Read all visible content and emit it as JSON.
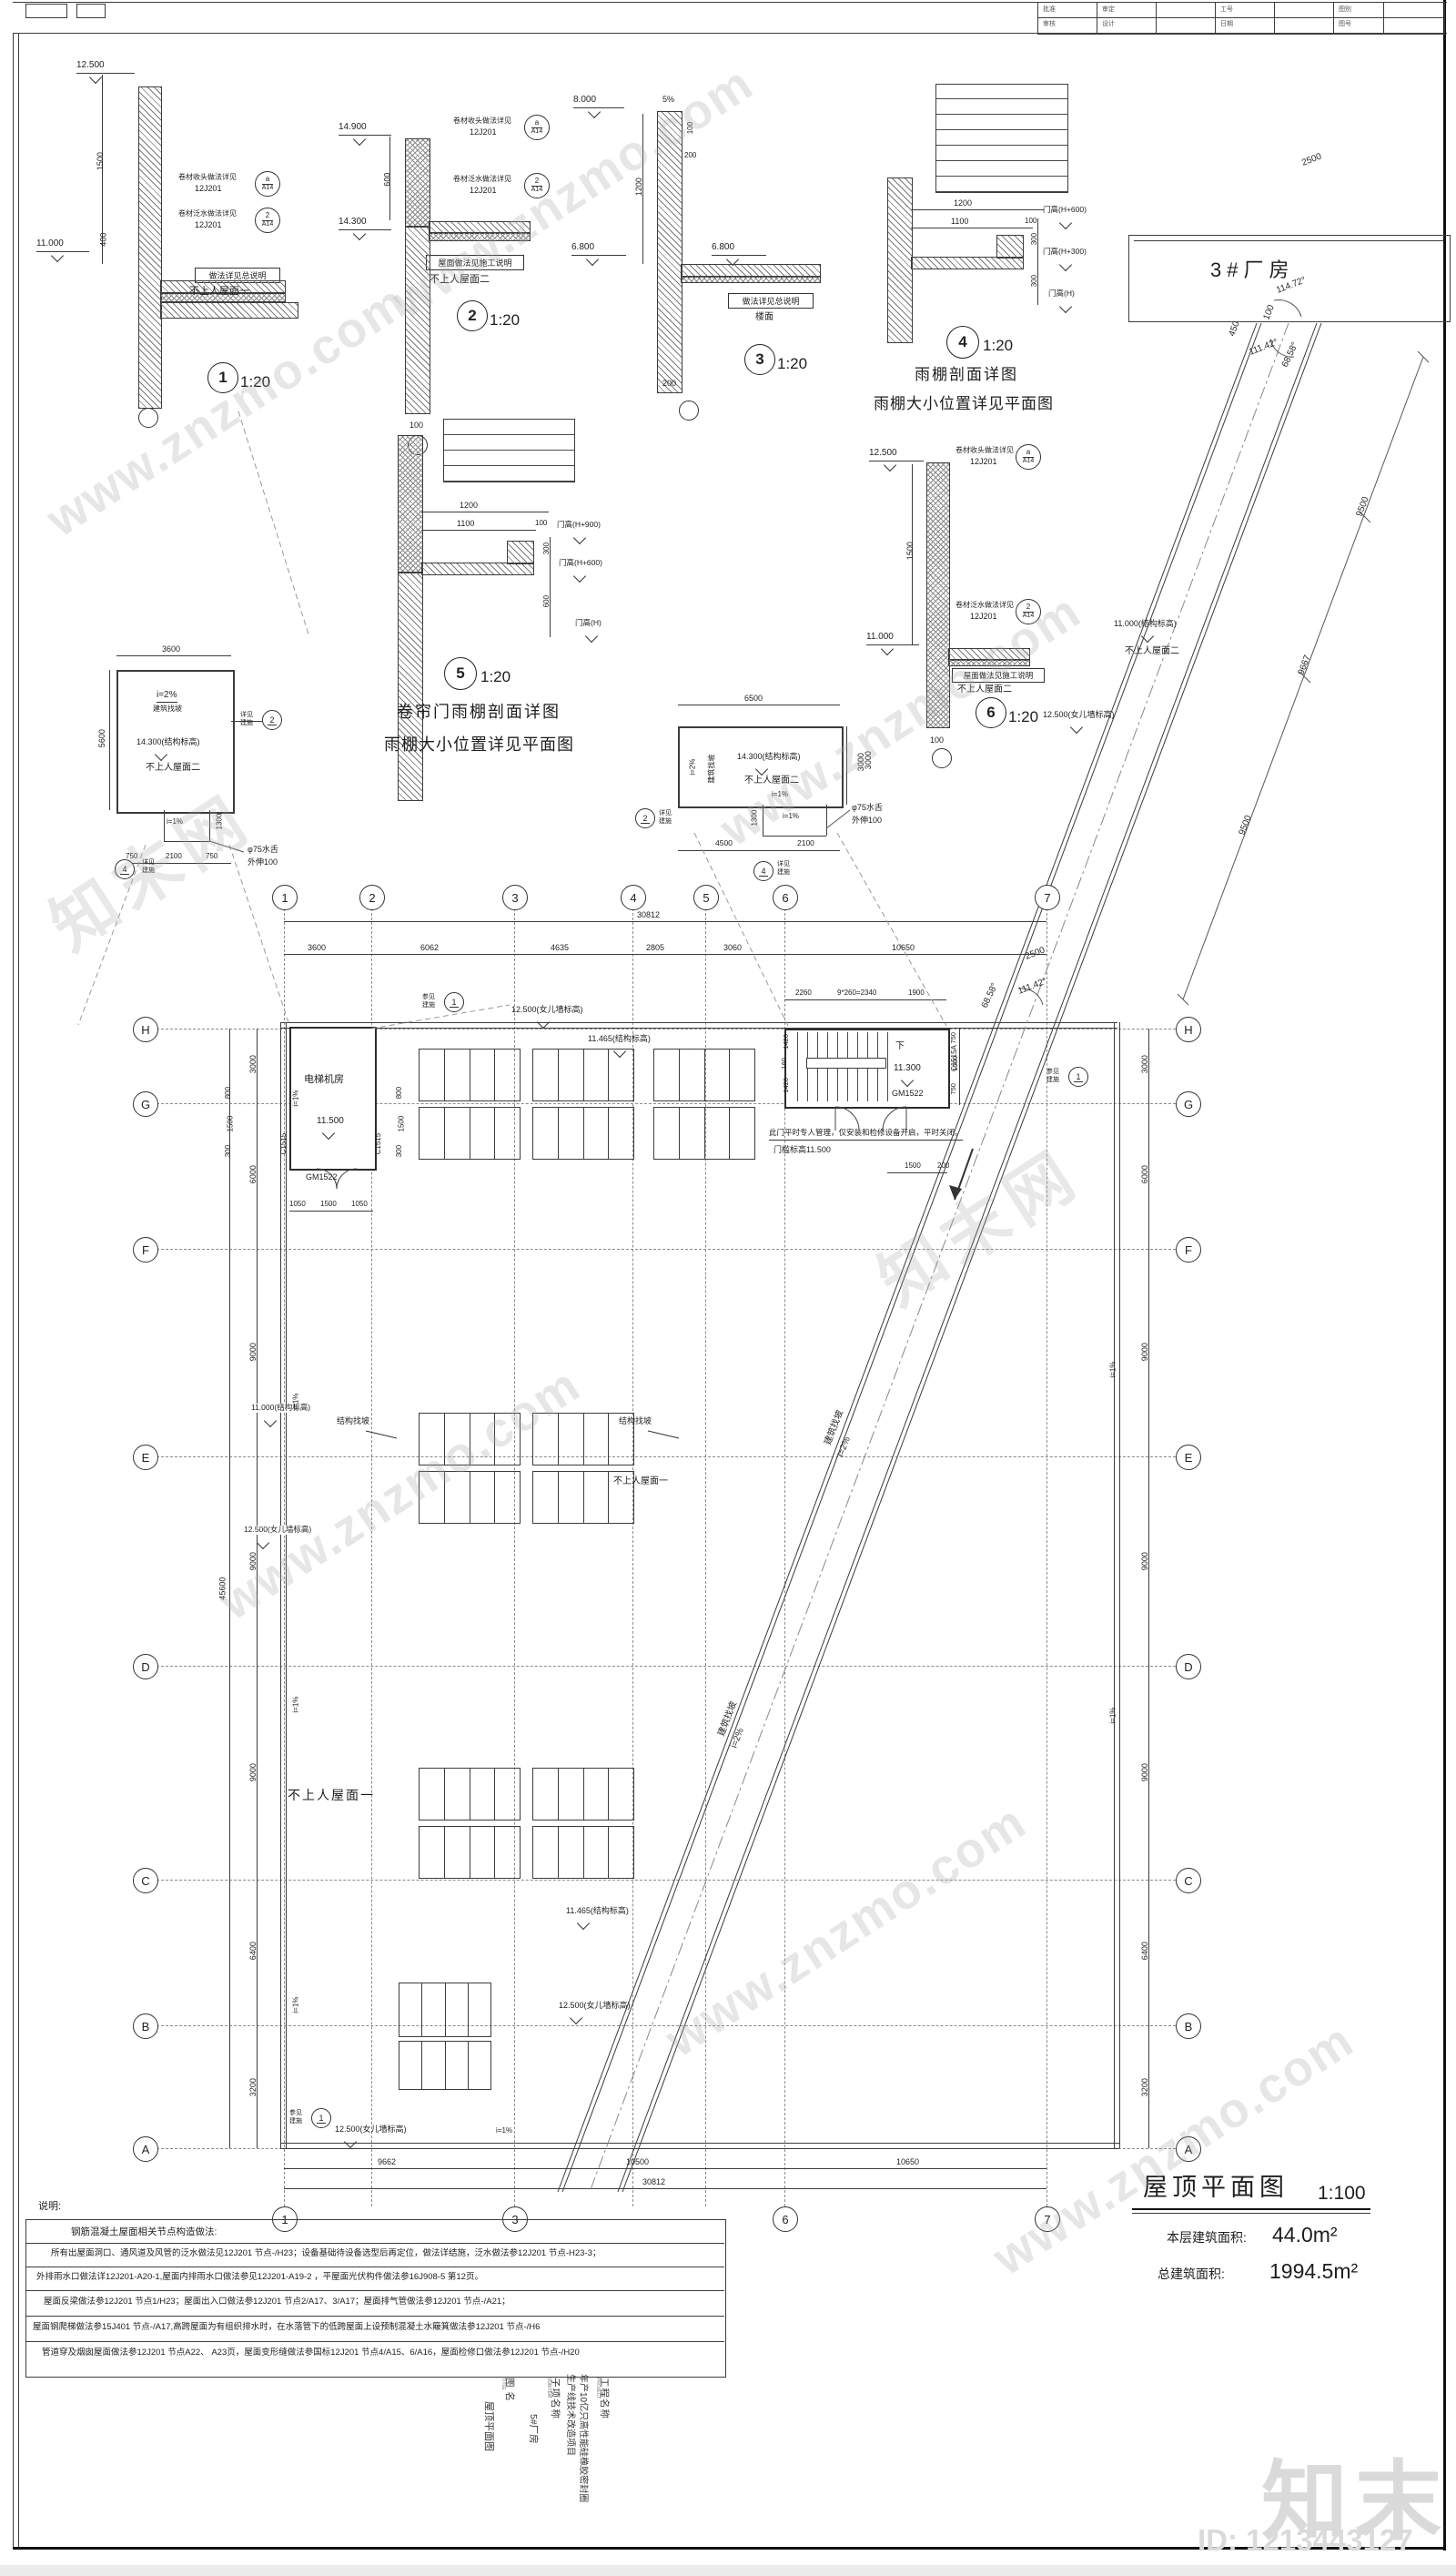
{
  "meta": {
    "site": "www.znzmo.com",
    "brand": "知末",
    "brand_cn": "知末网",
    "id_text": "ID: 1213443127"
  },
  "header": {
    "labels": [
      "批准",
      "审定",
      "工号",
      "图别",
      "审核",
      "设计",
      "日期",
      "图号"
    ]
  },
  "details": {
    "callout_head1": "卷材收头做法详见",
    "callout_head2": "12J201",
    "callout_flash1": "卷材泛水做法详见",
    "callout_flash2": "12J201",
    "ref_a": "a",
    "ref_a_sub": "A14",
    "ref_2": "2",
    "ref_2_sub": "A14",
    "d1": {
      "num": "1",
      "scale": "1:20",
      "lv_top": "12.500",
      "lv_bot": "11.000",
      "dim_a": "1500",
      "dim_b": "400",
      "note": "做法详见总说明",
      "roof": "不上人屋面一"
    },
    "d2": {
      "num": "2",
      "scale": "1:20",
      "lv_top": "14.900",
      "lv_bot": "14.300",
      "dim_a": "600",
      "dim_b": "100",
      "note": "屋面做法见施工说明",
      "roof": "不上人屋面二"
    },
    "d3": {
      "num": "3",
      "scale": "1:20",
      "lv_top": "8.000",
      "slope": "5%",
      "dim_a": "100",
      "dim_b": "200",
      "dim_c": "1200",
      "lv_l": "6.800",
      "lv_r": "6.800",
      "note": "做法详见总说明",
      "floor": "楼面",
      "dim_d": "200"
    },
    "d4": {
      "num": "4",
      "scale": "1:20",
      "dim_a": "1200",
      "dim_b": "1100",
      "dim_c": "100",
      "dim_d": "300",
      "dim_e": "300",
      "lv1": "门高(H+600)",
      "lv2": "门高(H+300)",
      "lv3": "门高(H)",
      "cap1": "雨棚剖面详图",
      "cap2": "雨棚大小位置详见平面图"
    },
    "d5": {
      "num": "5",
      "scale": "1:20",
      "dim_a": "1200",
      "dim_b": "1100",
      "dim_c": "100",
      "dim_d": "300",
      "dim_e": "600",
      "lv1": "门高(H+900)",
      "lv2": "门高(H+600)",
      "lv3": "门高(H)",
      "cap1": "卷帘门雨棚剖面详图",
      "cap2": "雨棚大小位置详见平面图"
    },
    "d6": {
      "num": "6",
      "scale": "1:20",
      "lv_top": "12.500",
      "lv_bot": "11.000",
      "dim_a": "1500",
      "dim_b": "100",
      "dim_c": "3000",
      "note": "屋面做法见施工说明",
      "roof": "不上人屋面二"
    }
  },
  "factory": {
    "name": "3#厂房"
  },
  "corridor": {
    "w2500": "2500",
    "len1": "9500",
    "len2": "9667",
    "len3": "9500",
    "ang1": "114.72°",
    "ang2": "111.42°",
    "ang3": "68.58°",
    "d450": "450",
    "d100": "100",
    "slope_label": "建筑找坡",
    "slope_val": "i=2%",
    "lv": "11.000(结构标高)",
    "roof": "不上人屋面二",
    "parapet": "12.500(女儿墙标高)"
  },
  "sp_left": {
    "dim_top": "3600",
    "dim_left": "5600",
    "slope_val": "i=2%",
    "slope_label": "建筑找坡",
    "level": "14.300(结构标高)",
    "roof": "不上人屋面二",
    "i1": "i=1%",
    "d1300": "1300",
    "d750a": "750",
    "d2100": "2100",
    "d750b": "750",
    "spout1": "φ75水舌",
    "spout2": "外伸100",
    "see1": "详见",
    "see2": "建施",
    "b2": "2",
    "b4": "4"
  },
  "sp_mid": {
    "dim_top": "6500",
    "dim_right": "3000",
    "slope_val": "i=2%",
    "slope_label": "建筑找坡",
    "level": "14.300(结构标高)",
    "roof": "不上人屋面二",
    "i1a": "i=1%",
    "i1b": "i=1%",
    "d1300": "1300",
    "d4500": "4500",
    "d2100": "2100",
    "spout1": "φ75水舌",
    "spout2": "外伸100",
    "see1": "详见",
    "see2": "建施",
    "b2": "2",
    "b4": "4"
  },
  "plan": {
    "bt": [
      "1",
      "2",
      "3",
      "4",
      "5",
      "6",
      "7"
    ],
    "bb": [
      "1",
      "3",
      "6",
      "7"
    ],
    "bl": [
      "H",
      "G",
      "F",
      "E",
      "D",
      "C",
      "B",
      "A"
    ],
    "br": [
      "H",
      "G",
      "F",
      "E",
      "D",
      "C",
      "B",
      "A"
    ],
    "dims_top": [
      "3600",
      "6062",
      "4635",
      "2805",
      "3060",
      "10650"
    ],
    "top_total": "30812",
    "dims_bottom": [
      "9662",
      "10500",
      "10650"
    ],
    "bottom_total": "30812",
    "dims_left": [
      "3000",
      "6000",
      "9000",
      "9000",
      "9000",
      "6400",
      "3200"
    ],
    "left_total": "45600",
    "dims_right": [
      "3000",
      "6000",
      "9000",
      "9000",
      "9000",
      "6400",
      "3200"
    ],
    "see1": "参见",
    "see2": "建施",
    "see_num": "1",
    "parapet_top": "12.500(女儿墙标高)",
    "struct_top": "11.465(结构标高)",
    "slope_struct": "结构找坡",
    "slope_struct2": "结构找坡",
    "roof_small": "不上人屋面一",
    "roof_big": "不上人屋面一",
    "lv_left": "11.000(结构标高)",
    "parapet_left": "12.500(女儿墙标高)",
    "struct_low": "11.465(结构标高)",
    "parapet_low": "12.500(女儿墙标高)",
    "parapet_bot": "12.500(女儿墙标高)",
    "i1": "i=1%",
    "elevator": {
      "name": "电梯机房",
      "level": "11.500",
      "win": "C1515",
      "win2": "C1515",
      "door": "GM1522",
      "d1": "1050",
      "d2": "1500",
      "d3": "1050",
      "w1": "800",
      "w2": "1500",
      "w3": "300"
    },
    "stair": {
      "down": "下",
      "level": "11.300",
      "door": "GM1522",
      "win": "C1515A",
      "t1": "2260",
      "t2": "9*260=2340",
      "t3": "1900",
      "l1": "1420",
      "l2": "160",
      "l3": "1420",
      "r1": "750",
      "r2": "1500",
      "r3": "750",
      "dd1": "1500",
      "dd2": "200",
      "note": "此门平时专人管理，仅安装和检修设备开启，平时关闭。",
      "sill": "门槛标高11.500"
    }
  },
  "notes": {
    "title": "说明:",
    "subtitle": "钢筋混凝土屋面相关节点构造做法:",
    "lines": [
      "所有出屋面洞口、通风道及风管的泛水做法见12J201 节点-/H23；设备基础待设备选型后再定位，做法详结施，泛水做法参12J201 节点-H23-3；",
      "外排雨水口做法详12J201-A20-1,屋面内排雨水口做法参见12J201-A19-2 ，平屋面光伏构件做法参16J908-5 第12页。",
      "屋面反梁做法参12J201 节点1/H23；屋面出入口做法参12J201 节点2/A17、3/A17；屋面排气管做法参12J201 节点-/A21；",
      "屋面钢爬梯做法参15J401 节点-/A17,高跨屋面为有组织排水时，在水落管下的低跨屋面上设预制混凝土水簸箕做法参12J201 节点-/H6",
      "管道穿及烟囱屋面做法参12J201 节点A22、 A23页，屋面变形缝做法参国标12J201 节点4/A15、6/A16，屋面检修口做法参12J201 节点-/H20"
    ]
  },
  "titlebar": {
    "title": "屋顶平面图",
    "scale": "1:100",
    "a1l": "本层建筑面积:",
    "a1v": "44.0m²",
    "a2l": "总建筑面积:",
    "a2v": "1994.5m²"
  },
  "titleblock": {
    "l1": "工程名称",
    "l1e": "PROJECT",
    "v1a": "年产10亿只高性能硅橡胶密封圈",
    "v1b": "生产线技术改造项目",
    "l2": "子项名称",
    "l2e": "SUBITEM",
    "v2": "5#厂房",
    "l3": "图 名",
    "l3e": "TITLE",
    "v3": "屋顶平面图"
  }
}
